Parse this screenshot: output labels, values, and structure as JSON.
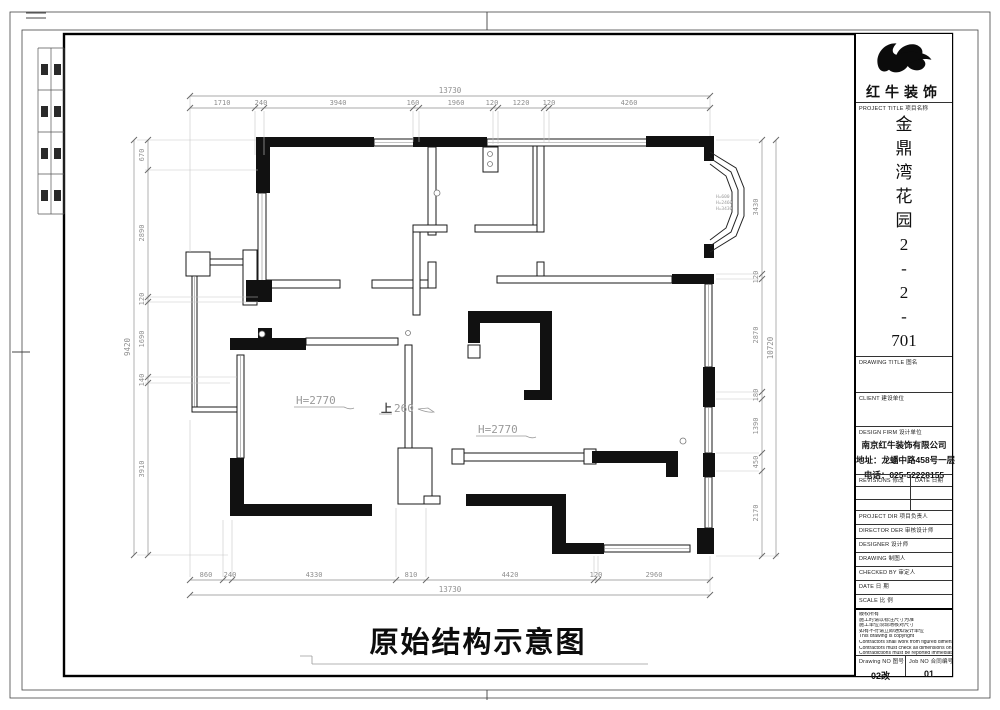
{
  "sheet": {
    "caption": "原始结构示意图",
    "plan_labels": {
      "height_left": "H=2770",
      "height_right": "H=2770",
      "step_word": "上",
      "step_value": "260",
      "bay_note_1": "H=600",
      "bay_note_2": "H=2460",
      "bay_note_3": "H=3430"
    },
    "dims": {
      "top": {
        "overall": "13730",
        "segments": [
          "1710",
          "240",
          "3940",
          "160",
          "1960",
          "120",
          "1220",
          "120",
          "4260"
        ]
      },
      "bottom": {
        "overall": "13730",
        "segments": [
          "860",
          "240",
          "4330",
          "810",
          "4420",
          "120",
          "2960"
        ]
      },
      "left": {
        "overall": "9420",
        "segments": [
          "670",
          "2890",
          "120",
          "1690",
          "140",
          "3910"
        ]
      },
      "right": {
        "overall": "10720",
        "segments": [
          "3430",
          "120",
          "2870",
          "180",
          "1390",
          "450",
          "2170"
        ]
      }
    }
  },
  "title_block": {
    "brand": "红牛装饰",
    "logo_icon": "bull-swoosh",
    "project_title_label": "PROJECT TITLE 项目名称",
    "project_name": "金鼎湾花园2-2-701",
    "project_name_chars": [
      "金",
      "鼎",
      "湾",
      "花",
      "园",
      "2",
      "-",
      "2",
      "-",
      "701"
    ],
    "drawing_title_label": "DRAWING TITLE 图名",
    "client_label": "CLIENT 建设单位",
    "design_firm_label": "DESIGN FIRM 设计单位",
    "firm_lines": [
      "南京红牛装饰有限公司",
      "地址：龙蟠中路458号一层",
      "电话：025-52228155"
    ],
    "revisions_label": "REVISIONS 修改",
    "date_col_label": "DATE 日期",
    "project_dir_label": "PROJECT DIR 项目负责人",
    "director_label": "DIRECTOR DER 审核设计师",
    "designer_label": "DESIGNER 设计师",
    "drawing_label": "DRAWING 制图人",
    "checked_label": "CHECKED BY 审定人",
    "date_label": "DATE 日 期",
    "scale_label": "SCALE 比 例",
    "notes": [
      "版权所有",
      "施工时请以标注尺寸为准",
      "施工单位须现场核对尺寸",
      "如有不符请立即通知设计单位",
      "This drawing is copyright",
      "Contractors shall work from figured dimensions only",
      "Contractors must check all dimensions on site",
      "Contradictions must be reported immediately to architects"
    ],
    "drawing_no_label": "Drawing NO 图号",
    "job_no_label": "Job NO 合同编号",
    "drawing_no_value": "02改",
    "job_no_value": "01"
  }
}
